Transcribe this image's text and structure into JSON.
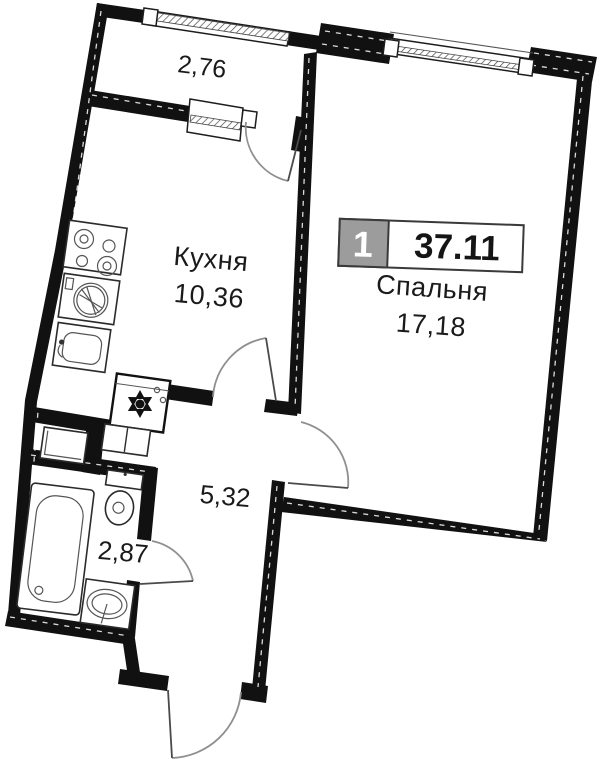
{
  "plan": {
    "badge": {
      "room_count": "1",
      "total_area": "37.11"
    },
    "rooms": {
      "bedroom": {
        "name": "Спальня",
        "area": "17,18"
      },
      "kitchen": {
        "name": "Кухня",
        "area": "10,36"
      },
      "hallway": {
        "area": "5,32"
      },
      "bathroom": {
        "area": "2,87"
      },
      "balcony": {
        "area": "2,76"
      }
    },
    "colors": {
      "wall": "#111111",
      "badge_gray": "#9c9c9c",
      "background": "#ffffff",
      "door_arc": "#8f8f8f"
    }
  }
}
